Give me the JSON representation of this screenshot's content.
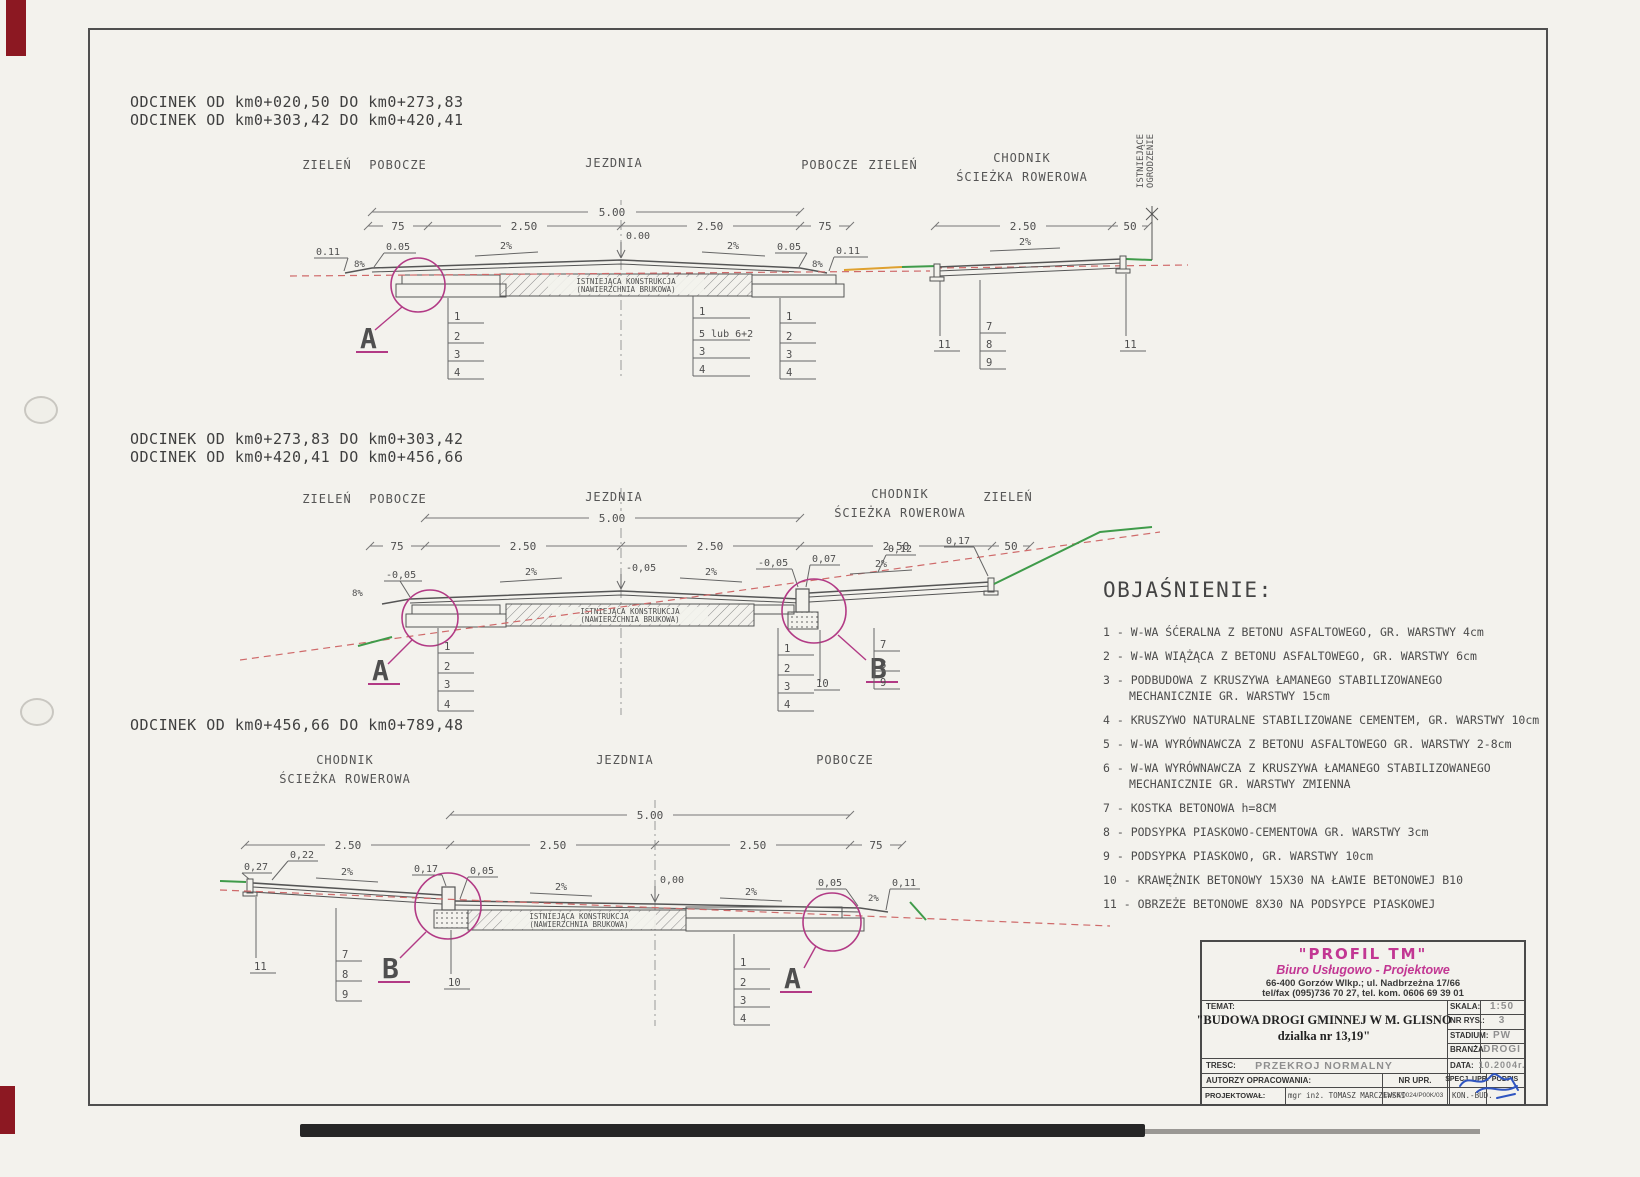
{
  "s1": {
    "title1": "ODCINEK OD km0+020,50 DO km0+273,83",
    "title2": "ODCINEK OD km0+303,42 DO km0+420,41",
    "zielen_l": "ZIELEŃ",
    "pobocze_l": "POBOCZE",
    "jezdnia": "JEZDNIA",
    "pobocze_r": "POBOCZE",
    "zielen_r": "ZIELEŃ",
    "chodnik1": "CHODNIK",
    "chodnik2": "ŚCIEŻKA ROWEROWA",
    "ogrodzenie": "ISTNIEJĄCE\nOGRODZENIE",
    "d500": "5.00",
    "d75l": "75",
    "d250l": "2.50",
    "d250r": "2.50",
    "d75r": "75",
    "d250c": "2.50",
    "d50": "50",
    "e011l": "0.11",
    "p8l": "8%",
    "e005l": "0.05",
    "p2l": "2%",
    "e000": "0.00",
    "p2r": "2%",
    "e005r": "0.05",
    "p8r": "8%",
    "e011r": "0.11",
    "p2c": "2%",
    "hatch1": "ISTNIEJĄCA KONSTRUKCJA",
    "hatch2": "(NAWIERZCHNIA BRUKOWA)",
    "sl": [
      "1",
      "2",
      "3",
      "4"
    ],
    "sm": [
      "1",
      "5 lub 6+2",
      "3",
      "4"
    ],
    "sr": [
      "1",
      "2",
      "3",
      "4"
    ],
    "c11l": "11",
    "sc": [
      "7",
      "8",
      "9"
    ],
    "c11r": "11",
    "A": "A"
  },
  "s2": {
    "title1": "ODCINEK OD km0+273,83 DO km0+303,42",
    "title2": "ODCINEK OD km0+420,41 DO km0+456,66",
    "zielen_l": "ZIELEŃ",
    "pobocze_l": "POBOCZE",
    "jezdnia": "JEZDNIA",
    "chodnik1": "CHODNIK",
    "chodnik2": "ŚCIEŻKA ROWEROWA",
    "zielen_r": "ZIELEŃ",
    "d500": "5.00",
    "d75": "75",
    "d250a": "2.50",
    "d250b": "2.50",
    "d250c": "2.50",
    "d50": "50",
    "e005l": "-0,05",
    "p8": "8%",
    "p2a": "2%",
    "e005c": "-0,05",
    "p2b": "2%",
    "e005r": "-0,05",
    "e007": "0,07",
    "p2c": "2%",
    "e012": "0,12",
    "e017": "0,17",
    "hatch1": "ISTNIEJĄCA KONSTRUKCJA",
    "hatch2": "(NAWIERZCHNIA BRUKOWA)",
    "sl": [
      "1",
      "2",
      "3",
      "4"
    ],
    "sr": [
      "1",
      "2",
      "3",
      "4"
    ],
    "c10": "10",
    "sc": [
      "7",
      "8",
      "9"
    ],
    "A": "A",
    "B": "B"
  },
  "s3": {
    "title1": "ODCINEK OD km0+456,66 DO km0+789,48",
    "chodnik1": "CHODNIK",
    "chodnik2": "ŚCIEŻKA ROWEROWA",
    "jezdnia": "JEZDNIA",
    "pobocze": "POBOCZE",
    "d500": "5.00",
    "d250a": "2.50",
    "d250b": "2.50",
    "d250c": "2.50",
    "d75": "75",
    "e027": "0,27",
    "e022": "0,22",
    "p2a": "2%",
    "e017": "0,17",
    "e005a": "0,05",
    "p2b": "2%",
    "e000": "0,00",
    "p2c": "2%",
    "e005b": "0,05",
    "p2d": "2%",
    "e011": "0,11",
    "hatch1": "ISTNIEJĄCA KONSTRUKCJA",
    "hatch2": "(NAWIERZCHNIA BRUKOWA)",
    "c11": "11",
    "sc": [
      "7",
      "8",
      "9"
    ],
    "c10": "10",
    "sr": [
      "1",
      "2",
      "3",
      "4"
    ],
    "A": "A",
    "B": "B"
  },
  "legend": {
    "title": "OBJAŚNIENIE:",
    "items": [
      "1 - W-WA ŚĆERALNA Z BETONU ASFALTOWEGO, GR. WARSTWY 4cm",
      "2 - W-WA WIĄŻĄCA Z BETONU ASFALTOWEGO, GR. WARSTWY 6cm",
      "3 - PODBUDOWA Z KRUSZYWA ŁAMANEGO STABILIZOWANEGO\nMECHANICZNIE GR. WARSTWY 15cm",
      "4 - KRUSZYWO NATURALNE STABILIZOWANE CEMENTEM, GR. WARSTWY 10cm",
      "5 - W-WA WYRÓWNAWCZA Z BETONU ASFALTOWEGO GR. WARSTWY 2-8cm",
      "6 - W-WA WYRÓWNAWCZA Z KRUSZYWA ŁAMANEGO STABILIZOWANEGO\nMECHANICZNIE GR. WARSTWY ZMIENNA",
      "7 - KOSTKA BETONOWA h=8CM",
      "8 - PODSYPKA PIASKOWO-CEMENTOWA GR. WARSTWY 3cm",
      "9 - PODSYPKA PIASKOWO, GR. WARSTWY 10cm",
      "10 - KRAWĘŻNIK BETONOWY 15X30 NA ŁAWIE BETONOWEJ B10",
      "11 - OBRZEŻE BETONOWE 8X30 NA PODSYPCE PIASKOWEJ"
    ]
  },
  "tb": {
    "company": "\"PROFIL TM\"",
    "company2": "Biuro Usługowo - Projektowe",
    "addr1": "66-400 Gorzów Wlkp.; ul. Nadbrzeżna 17/66",
    "addr2": "tel/fax (095)736 70 27, tel. kom. 0606 69 39 01",
    "temat_label": "TEMAT:",
    "temat1": "\"BUDOWA DROGI GMINNEJ W M. GLISNO",
    "temat2": "dzialka nr 13,19\"",
    "tresc_label": "TRESC:",
    "tresc": "PRZEKROJ NORMALNY",
    "skala_label": "SKALA:",
    "skala": "1:50",
    "nrrys_label": "NR RYS.:",
    "nrrys": "3",
    "stadium_label": "STADIUM:",
    "stadium": "PW",
    "branza_label": "BRANŻA:",
    "branza": "DROGI",
    "data_label": "DATA:",
    "data": "10.2004r.",
    "autorzy_label": "AUTORZY OPRACOWANIA:",
    "nrupr_label": "NR UPR.",
    "specupr_label": "SPECJ. UPR.",
    "podpis_label": "PODPIS",
    "proj_label": "PROJEKTOWAŁ:",
    "proj_name": "mgr inż. TOMASZ MARCZEWSKI",
    "proj_nrupr": "LUK6/0024/P00K/03",
    "proj_spec": "KON.-BUD."
  }
}
